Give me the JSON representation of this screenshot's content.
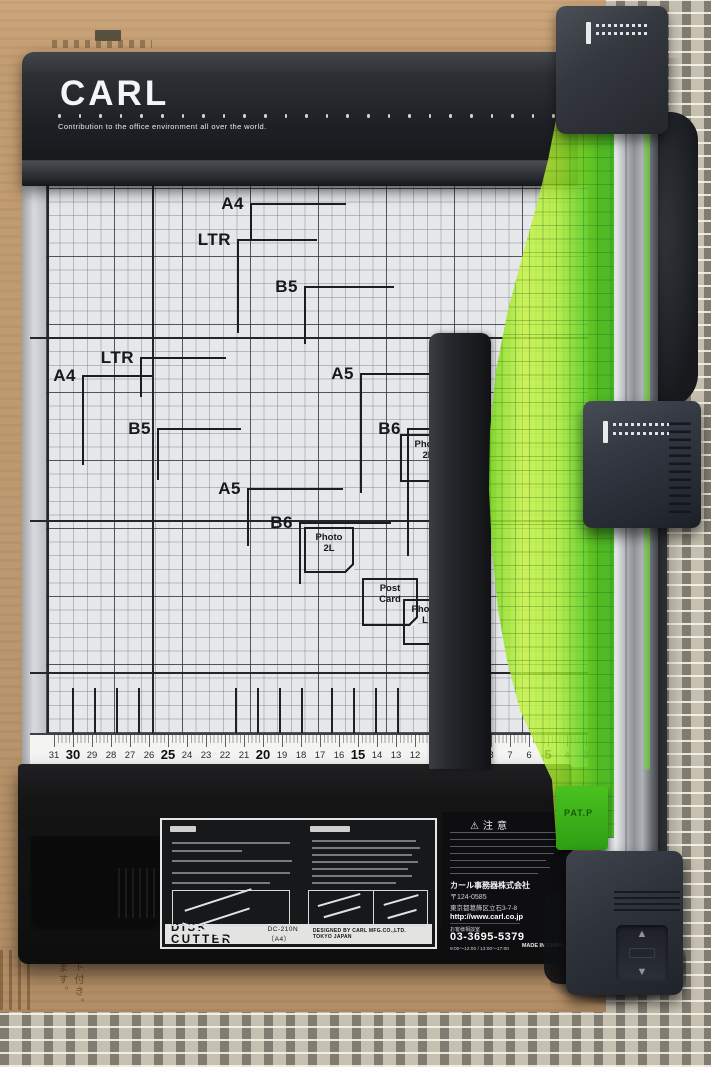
{
  "device": {
    "brand": "CARL",
    "tagline": "Contribution to the office environment all over the world.",
    "pat_label": "PAT.P"
  },
  "board": {
    "size_markers": [
      {
        "label": "A4",
        "x": 250,
        "y": 203,
        "h": 96,
        "v": 36
      },
      {
        "label": "LTR",
        "x": 237,
        "y": 239,
        "h": 80,
        "v": 94
      },
      {
        "label": "B5",
        "x": 304,
        "y": 286,
        "h": 90,
        "v": 58
      },
      {
        "label": "LTR",
        "x": 140,
        "y": 357,
        "h": 86,
        "v": 40
      },
      {
        "label": "A4",
        "x": 82,
        "y": 375,
        "h": 70,
        "v": 90
      },
      {
        "label": "B5",
        "x": 157,
        "y": 428,
        "h": 84,
        "v": 52
      },
      {
        "label": "A5",
        "x": 360,
        "y": 373,
        "h": 70,
        "v": 120
      },
      {
        "label": "B6",
        "x": 407,
        "y": 428,
        "h": 26,
        "v": 128
      },
      {
        "label": "A5",
        "x": 247,
        "y": 488,
        "h": 96,
        "v": 58
      },
      {
        "label": "B6",
        "x": 299,
        "y": 522,
        "h": 92,
        "v": 62
      }
    ],
    "photo_boxes": [
      {
        "lines": [
          "Photo",
          "2L"
        ],
        "x": 400,
        "y": 434,
        "w": 56,
        "h": 48
      },
      {
        "lines": [
          "Photo",
          "2L"
        ],
        "x": 304,
        "y": 527,
        "w": 50,
        "h": 46
      },
      {
        "lines": [
          "Post",
          "Card"
        ],
        "x": 362,
        "y": 578,
        "w": 56,
        "h": 48
      },
      {
        "lines": [
          "Photo",
          "L"
        ],
        "x": 403,
        "y": 599,
        "w": 44,
        "h": 46
      }
    ]
  },
  "ruler": {
    "numbers": [
      31,
      30,
      29,
      28,
      27,
      26,
      25,
      24,
      23,
      22,
      21,
      20,
      19,
      18,
      17,
      16,
      15,
      14,
      13,
      12,
      11,
      10,
      9,
      8,
      7,
      6,
      5,
      4,
      3
    ]
  },
  "instruction_label": {
    "title": "DISK CUTTER",
    "model": "DC-210N〔A4〕",
    "credit": "DESIGNED BY CARL MFG.CO.,LTD. TOKYO JAPAN"
  },
  "warning_label": {
    "warning_icon": "⚠",
    "caution": "注意",
    "company": "カール事務器株式会社",
    "postal": "〒124-0585",
    "address": "東京都葛飾区立石3-7-8",
    "url": "http://www.carl.co.jp",
    "support": "お客様相談室",
    "phone": "03-3695-5379",
    "hours": "9:00〜12:00 / 13:00〜17:00",
    "origin": "MADE IN CHINA"
  },
  "cardboard": {
    "vertical_text_1": "ット付き。",
    "vertical_text_2": "ます。"
  },
  "colors": {
    "guide_green": "#9ee61c",
    "deep_green": "#3fbf17",
    "base_black": "#141416",
    "bar_charcoal": "#2b2e33",
    "board_gray": "#e6e7e9",
    "mat_beige": "#c6c0b0",
    "cardboard_tan": "#bf9a6f"
  }
}
